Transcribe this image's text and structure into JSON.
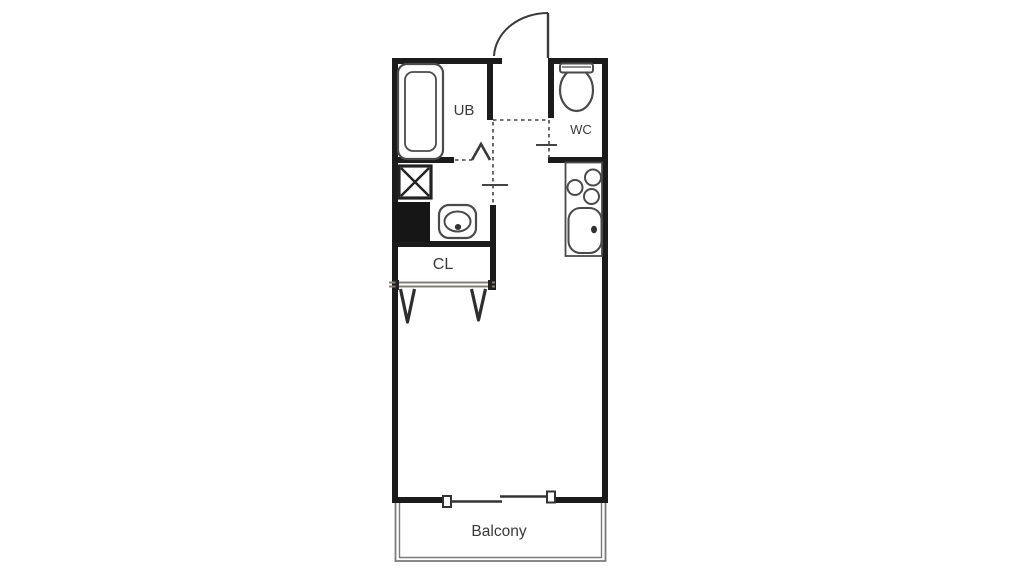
{
  "floorplan": {
    "kind": "studio-apartment-floor-plan",
    "labels": {
      "unit_bath": "UB",
      "toilet": "WC",
      "closet": "CL",
      "balcony": "Balcony"
    },
    "fixtures": [
      "bathtub",
      "toilet",
      "entrance-door-swing",
      "washing-machine-pan",
      "pipe-space-block",
      "washbasin",
      "kitchen-stove-burners",
      "kitchen-sink",
      "closet-double-doors",
      "sliding-window",
      "balcony"
    ],
    "colors": {
      "wall": "#1b1b1b",
      "fixture_outline": "#4a4a4a",
      "dashed_partition": "#444444",
      "balcony_outline": "#7a7a7a",
      "label_text": "#3a3a3a",
      "solid_block": "#161616",
      "background": "#ffffff"
    }
  }
}
